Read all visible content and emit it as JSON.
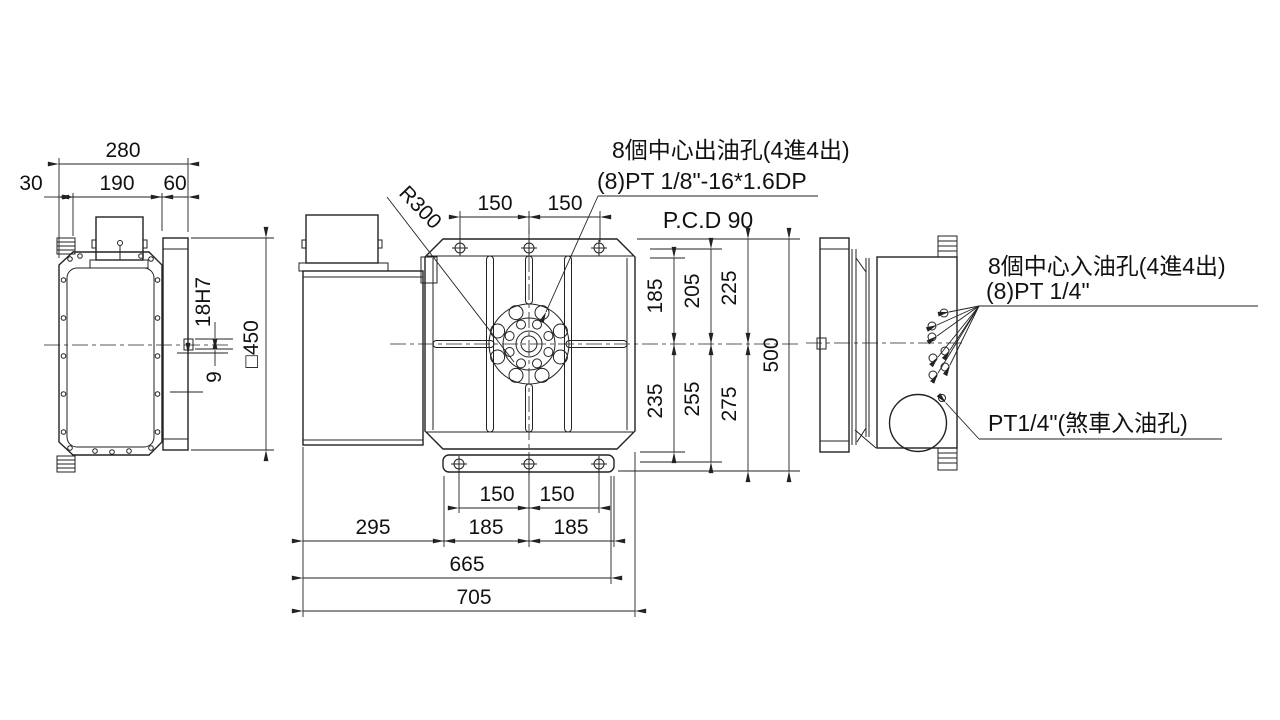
{
  "drawing": {
    "bg": "#ffffff",
    "line_color": "#222222",
    "left_view": {
      "dims": {
        "overall": "280",
        "left": "30",
        "middle": "190",
        "right": "60",
        "bore": "18H7",
        "offset": "9",
        "square": "□450"
      }
    },
    "front_view": {
      "labels": {
        "radius": "R300",
        "pcd": "P.C.D 90",
        "oil_out_1": "8個中心出油孔(4進4出)",
        "oil_out_2": "(8)PT 1/8\"-16*1.6DP"
      },
      "dims": {
        "top_150_left": "150",
        "top_150_right": "150",
        "up_185": "185",
        "up_205": "205",
        "up_225": "225",
        "down_235": "235",
        "down_255": "255",
        "down_275": "275",
        "height_500": "500",
        "bot_150_left": "150",
        "bot_150_right": "150",
        "bot_185_left": "185",
        "bot_185_right": "185",
        "bot_295": "295",
        "bot_665": "665",
        "bot_705": "705"
      }
    },
    "right_view": {
      "labels": {
        "oil_in_1": "8個中心入油孔(4進4出)",
        "oil_in_2": "(8)PT 1/4\"",
        "brake": "PT1/4\"(煞車入油孔)"
      }
    }
  }
}
